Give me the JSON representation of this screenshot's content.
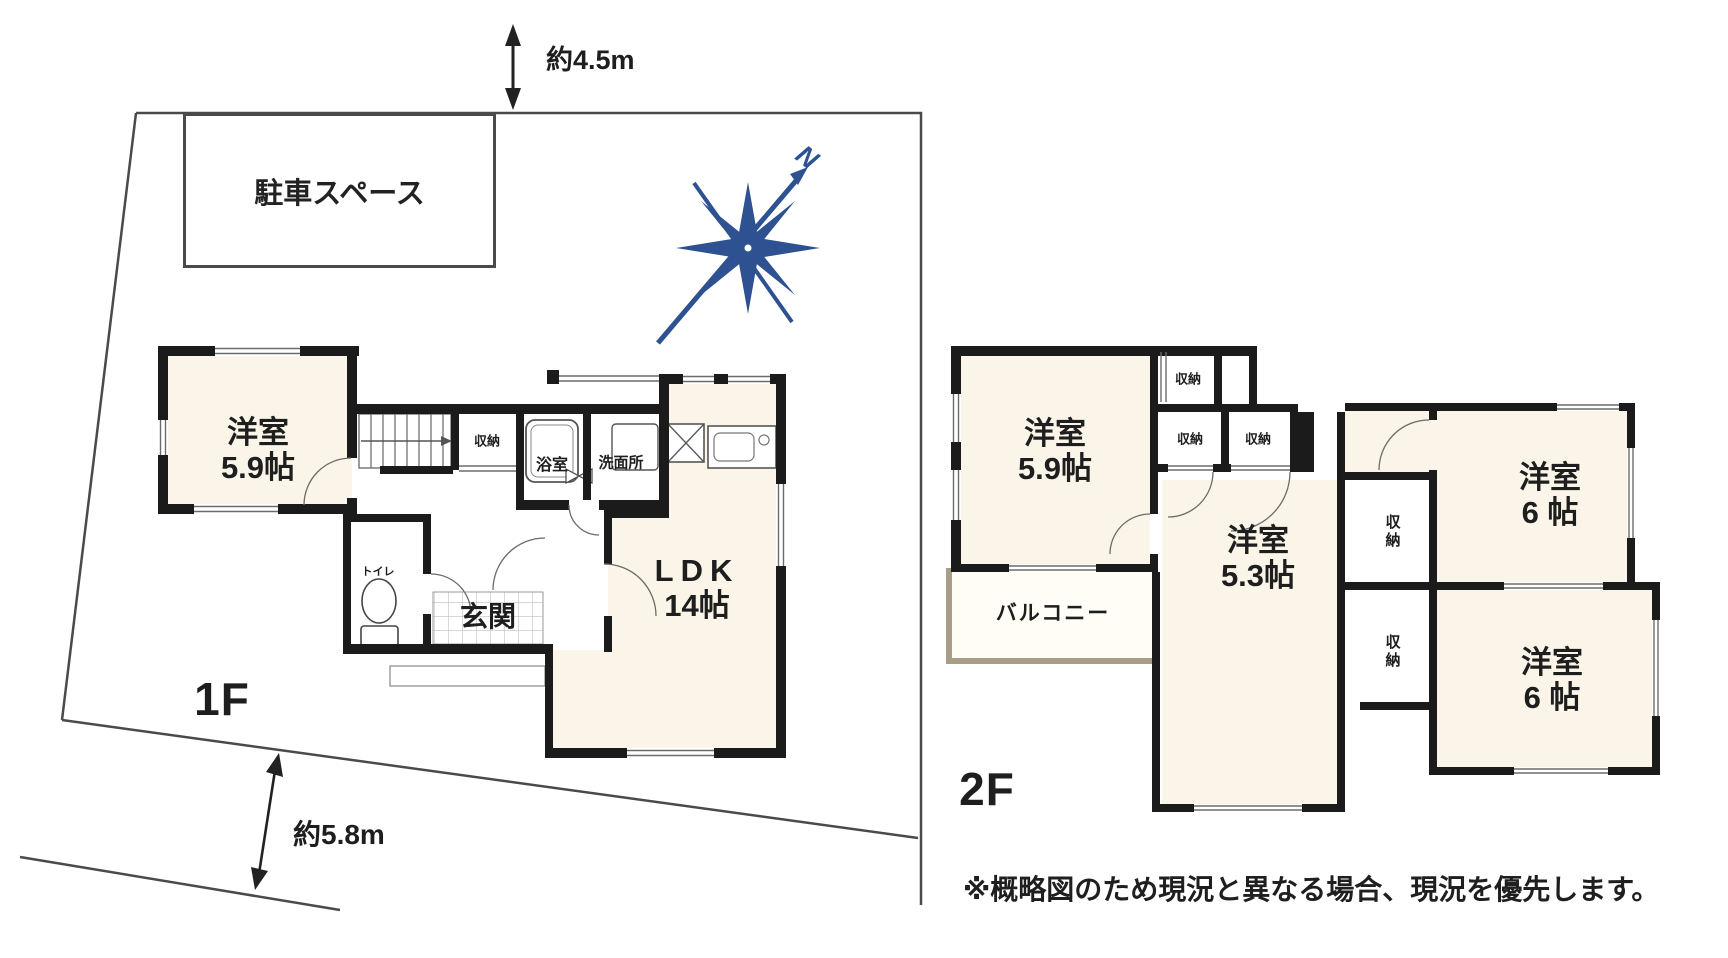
{
  "colors": {
    "wall": "#1b1b1b",
    "room_fill": "#faf5e8",
    "compass_blue": "#2d5191",
    "balcony_wall": "#a89d86",
    "thin_line": "#6b6b6b"
  },
  "site": {
    "parking": "駐車スペース",
    "dim_top": "約4.5m",
    "dim_side": "約5.8m",
    "north": "N"
  },
  "floor1": {
    "label": "1F",
    "yoshitsu": {
      "name": "洋室",
      "size": "5.9帖"
    },
    "ldk": {
      "name": "LDK",
      "size": "14帖"
    },
    "genkan": "玄関",
    "toilet": "トイレ",
    "bath": "浴室",
    "washroom": "洗面所",
    "closet": "収納"
  },
  "floor2": {
    "label": "2F",
    "yoshitsu59": {
      "name": "洋室",
      "size": "5.9帖"
    },
    "yoshitsu53": {
      "name": "洋室",
      "size": "5.3帖"
    },
    "yoshitsu6a": {
      "name": "洋室",
      "size": "6 帖"
    },
    "yoshitsu6b": {
      "name": "洋室",
      "size": "6 帖"
    },
    "balcony": "バルコニー",
    "closet_a": "収納",
    "closet_b": "収納",
    "closet_c": "収納",
    "closet_d": "収納",
    "closet_e": "収納"
  },
  "note": "※概略図のため現況と異なる場合、現況を優先します。"
}
